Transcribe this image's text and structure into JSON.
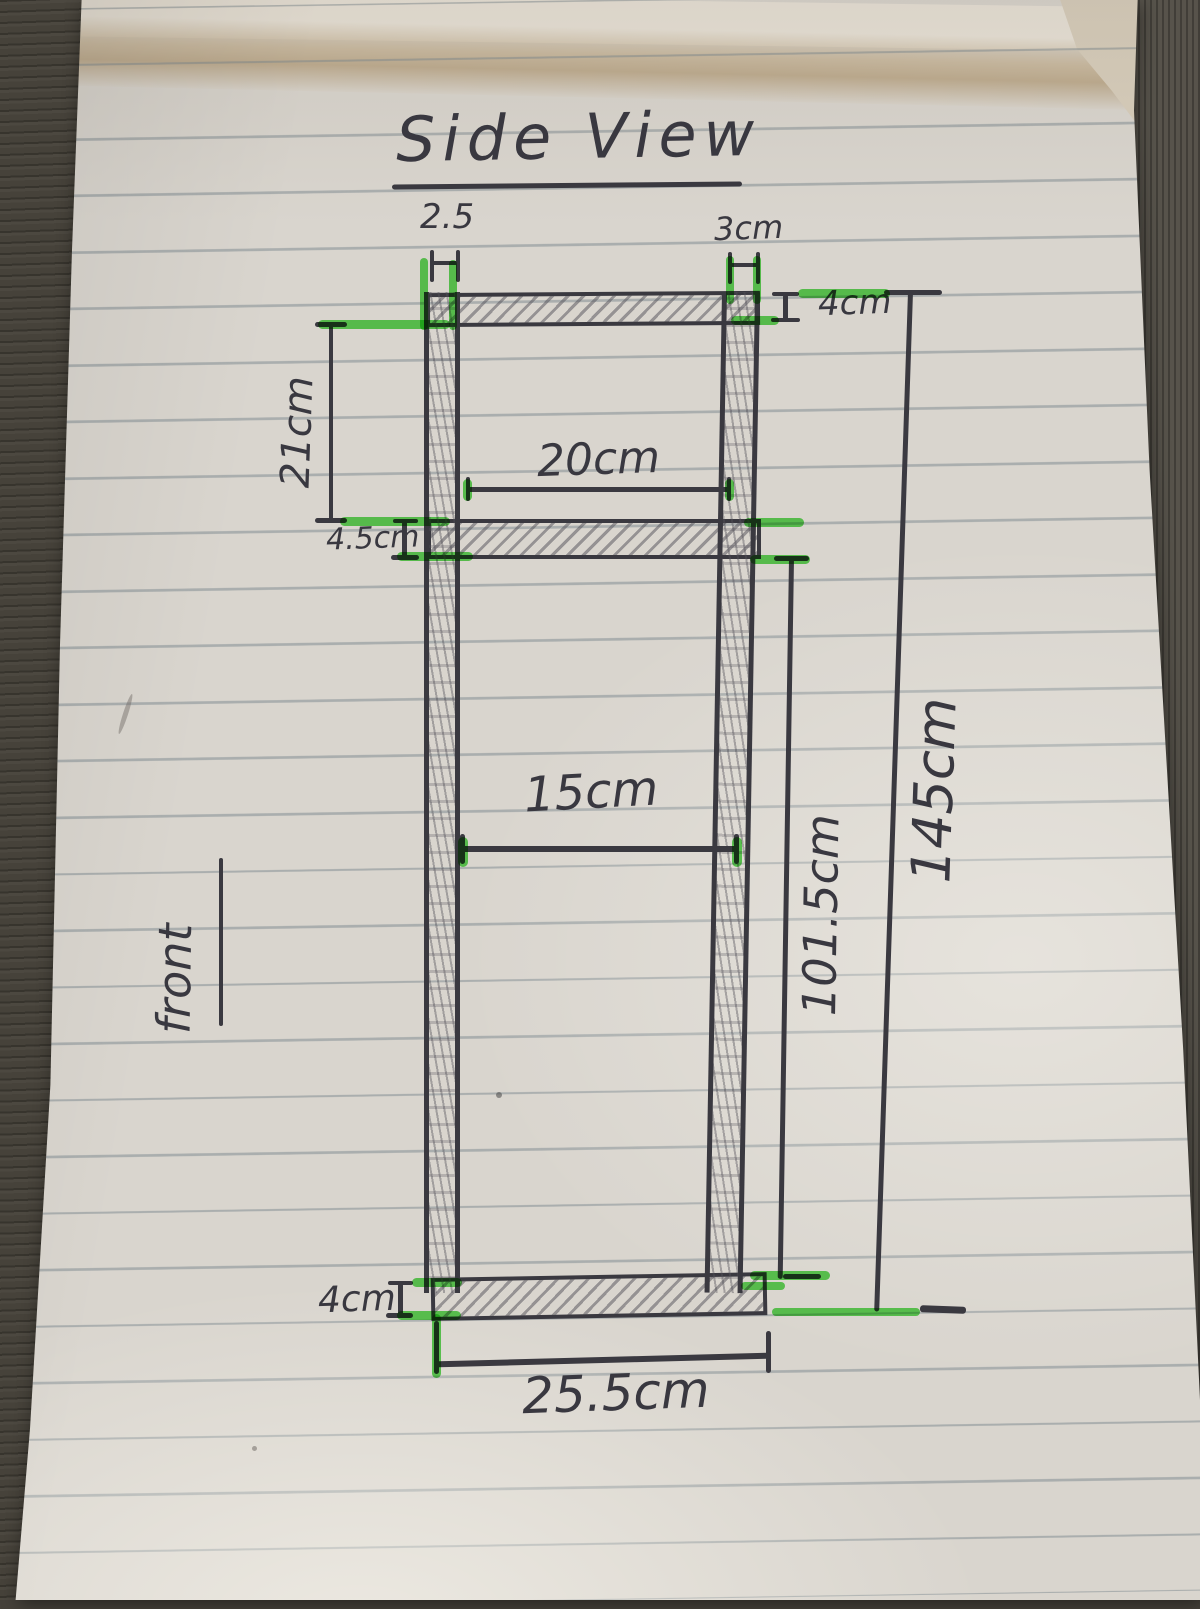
{
  "sketch": {
    "title": "Side View",
    "front_label": "front",
    "dims": {
      "left_wall_thickness": "2.5",
      "right_wall_thickness": "3cm",
      "top_panel_thickness": "4cm",
      "upper_compartment_height": "21cm",
      "upper_compartment_width": "20cm",
      "middle_shelf_thickness": "4.5cm",
      "lower_compartment_width": "15cm",
      "lower_section_height": "101.5cm",
      "overall_height": "145cm",
      "bottom_panel_thickness": "4cm",
      "overall_depth": "25.5cm"
    }
  },
  "colors": {
    "ink": "#3a3940",
    "highlighter_green": "#3ad630",
    "paper": "#d9d5ce",
    "rule_line": "#7c888e",
    "crease_tan": "#c7b598",
    "desk_wood": "#46423a"
  }
}
